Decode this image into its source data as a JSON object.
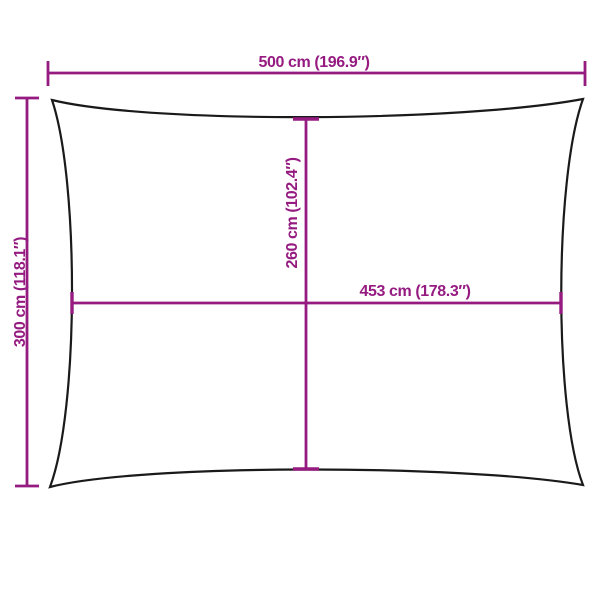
{
  "colors": {
    "dimension_line": "#951B81",
    "sail_outline": "#1A1A1A",
    "background": "#FFFFFF"
  },
  "diagram": {
    "kind": "rectangular-shade-sail-dimension-diagram",
    "dimensions": {
      "overall_width": {
        "label": "500 cm (196.9″)",
        "cm": 500,
        "inches": 196.9
      },
      "overall_height": {
        "label": "300 cm (118.1″)",
        "cm": 300,
        "inches": 118.1
      },
      "inner_height": {
        "label": "260 cm (102.4″)",
        "cm": 260,
        "inches": 102.4
      },
      "inner_width": {
        "label": "453 cm (178.3″)",
        "cm": 453,
        "inches": 178.3
      }
    }
  }
}
